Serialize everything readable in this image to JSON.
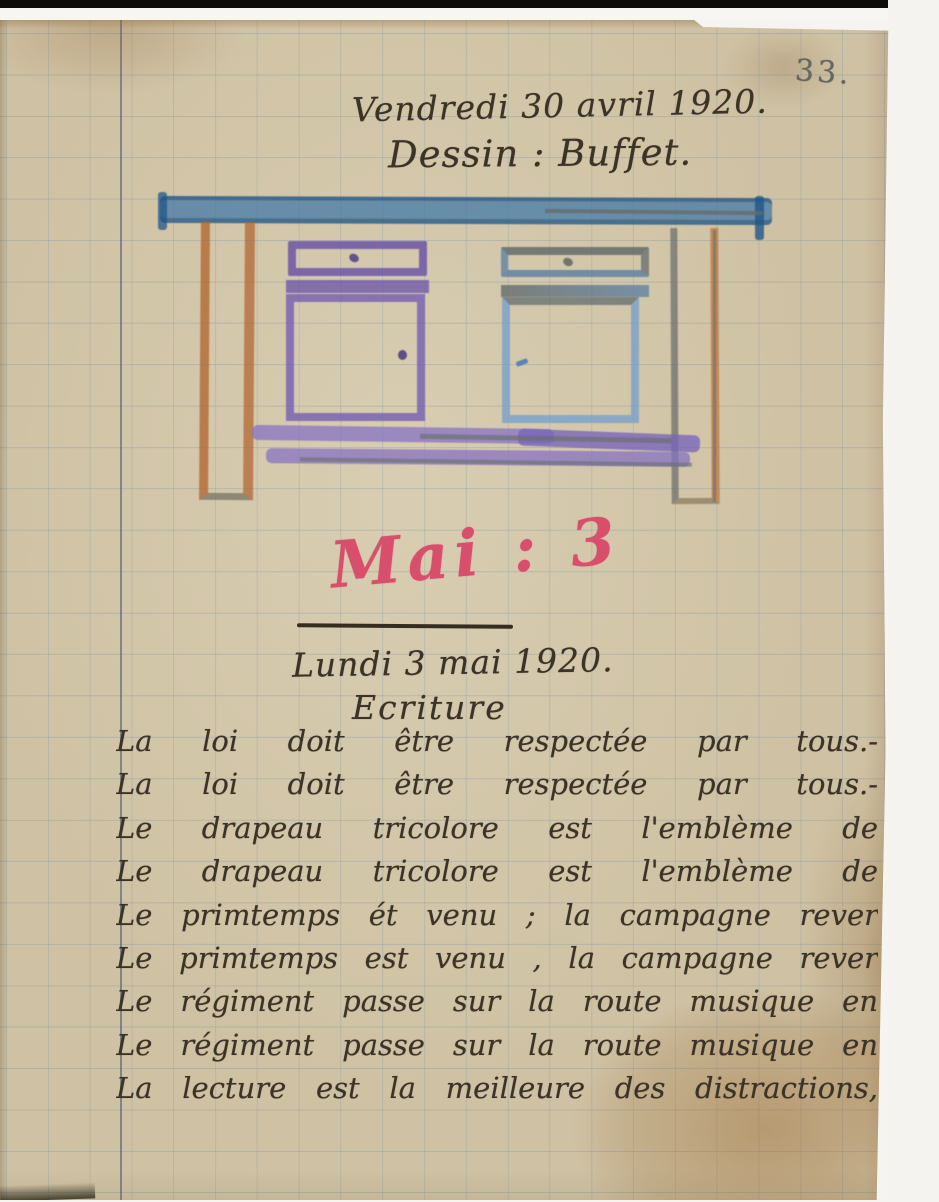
{
  "page": {
    "number": "33.",
    "paper_color": "#cfc2a4",
    "grid_color": "#7a94a8",
    "margin_line_color": "#3e5470",
    "ink_color": "#3c3327"
  },
  "header": {
    "date_line": "Vendredi 30 avril 1920.",
    "subject_line": "Dessin : Buffet."
  },
  "drawing": {
    "subject": "buffet-sideboard-crayon-drawing",
    "colors": {
      "top_bar": "#3873a7",
      "legs_orange": "#b26731",
      "left_cabinet_purple": "#6850a7",
      "right_cabinet_blue": "#76a0ca",
      "shelf_lilac": "#8470c3",
      "pencil_gray": "#686e6c"
    }
  },
  "month_heading": {
    "text": "Mai : 3",
    "color": "#d84f6c"
  },
  "entry": {
    "date_line": "Lundi 3 mai 1920.",
    "subject_line": "Ecriture"
  },
  "writing": {
    "lines": [
      "La loi doit être respectée par tous.-",
      "La loi doit être respectée par tous.-",
      "Le drapeau tricolore est l'emblème de",
      "Le drapeau tricolore est l'emblème de",
      "Le primtemps ét venu ; la campagne rever",
      "Le primtemps est venu , la campagne rever",
      "Le régiment passe sur la route musique en",
      "Le régiment passe sur la route musique en",
      "La lecture est la meilleure des distractions,"
    ]
  }
}
